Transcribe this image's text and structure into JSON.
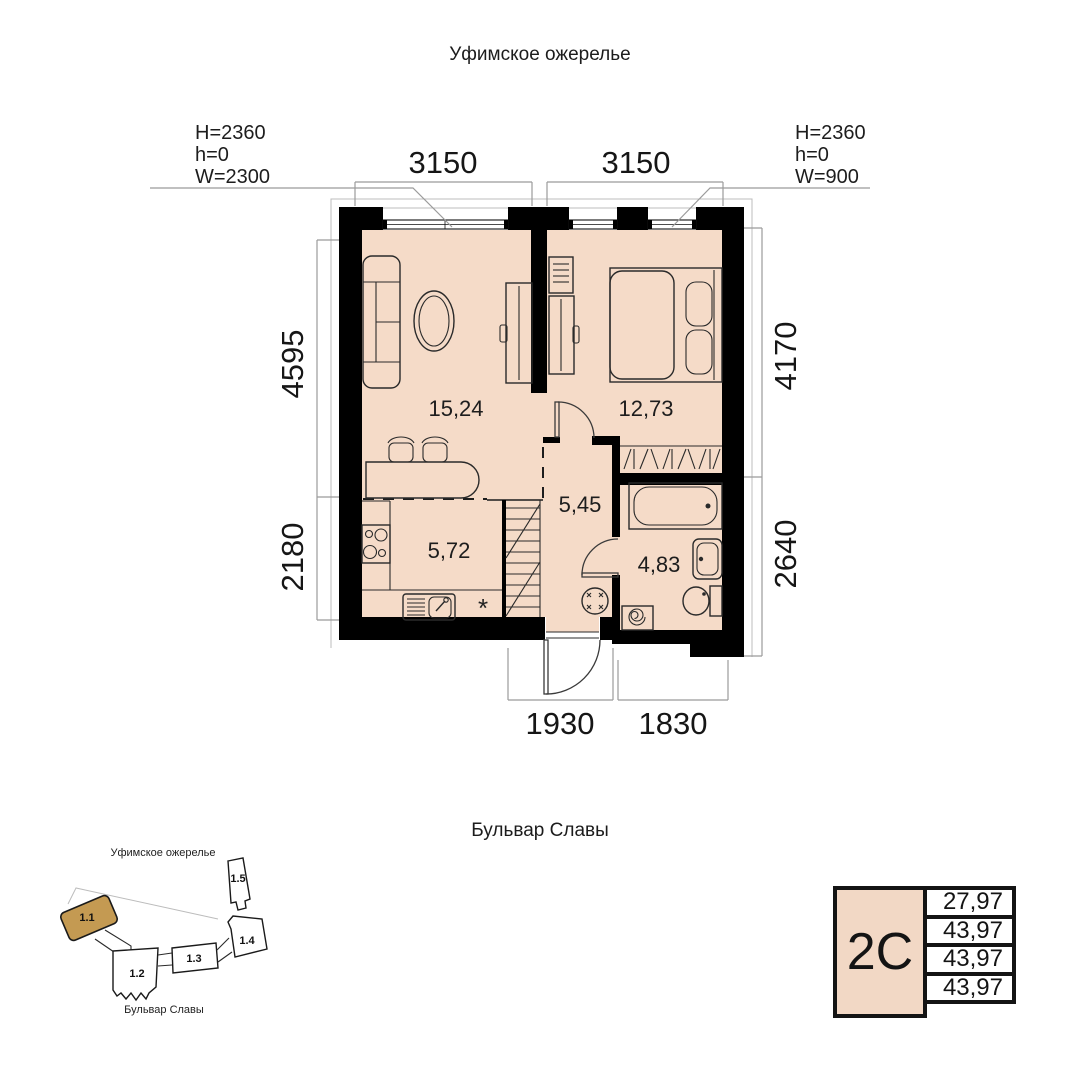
{
  "titles": {
    "top": "Уфимское ожерелье",
    "bottom": "Бульвар Славы"
  },
  "dims": {
    "top_left": "3150",
    "top_right": "3150",
    "left_top": "4595",
    "left_bottom": "2180",
    "right_top": "4170",
    "right_bottom": "2640",
    "bottom_left": "1930",
    "bottom_right": "1830"
  },
  "annotations": {
    "left": {
      "l1": "H=2360",
      "l2": "h=0",
      "l3": "W=2300"
    },
    "right": {
      "l1": "H=2360",
      "l2": "h=0",
      "l3": "W=900"
    }
  },
  "rooms": {
    "living": "15,24",
    "bedroom": "12,73",
    "hall": "5,45",
    "kitchen": "5,72",
    "bathroom": "4,83"
  },
  "kitchen_note": "*",
  "site": {
    "street_top": "Уфимское ожерелье",
    "street_bottom": "Бульвар Славы",
    "b1": "1.1",
    "b2": "1.2",
    "b3": "1.3",
    "b4": "1.4",
    "b5": "1.5",
    "highlighted_building": "1.1"
  },
  "table": {
    "type": "2С",
    "v1": "27,97",
    "v2": "43,97",
    "v3": "43,97",
    "v4": "43,97"
  },
  "colors": {
    "floor": "#f5dbc8",
    "wall": "#000000",
    "dim_line": "#9b9b9b",
    "site_highlight": "#c49a52",
    "table_type_bg": "#f2d8c5"
  }
}
